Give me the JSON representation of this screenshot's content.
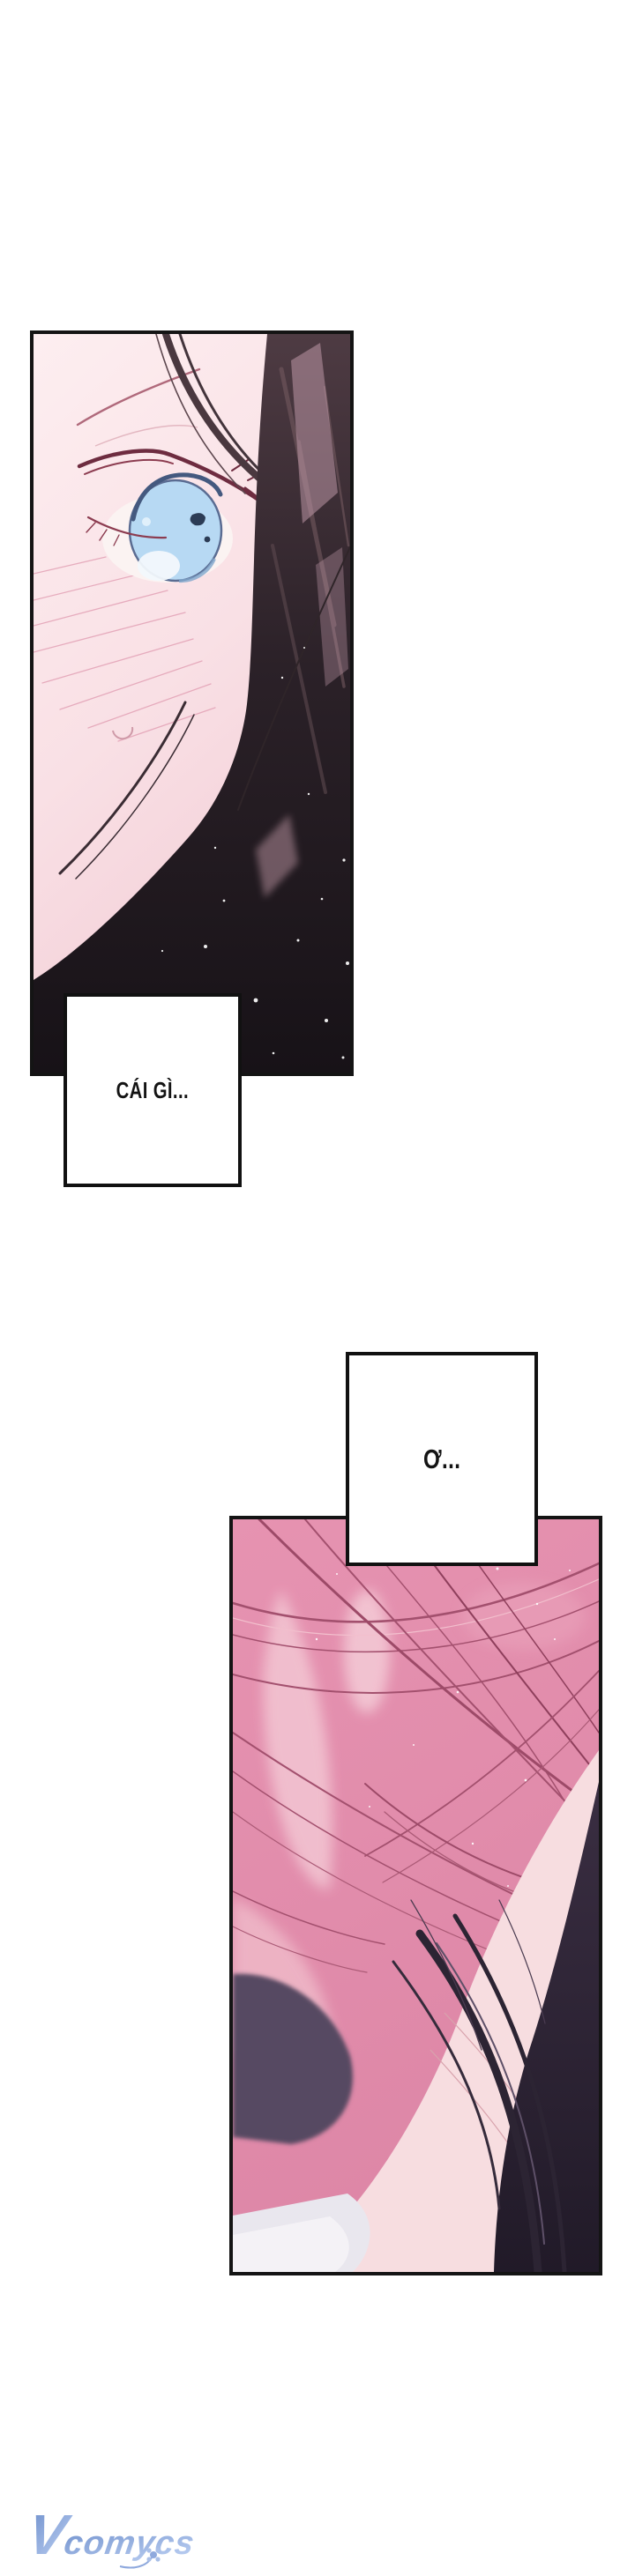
{
  "page": {
    "background": "#ffffff"
  },
  "speech": {
    "box1": "CÁI GÌ...",
    "box2": "Ơ..."
  },
  "watermark": {
    "initial": "V",
    "rest": "comycs"
  },
  "colors": {
    "panel_border": "#141414",
    "speech_text": "#141414",
    "skin_pale_pink": "#f8e3e6",
    "iris_blue": "#b7d9f3",
    "dark_hair": "#241d22",
    "pink_hair": "#e28fae",
    "pink_hair_line": "#a3506e",
    "shoulder_purple": "#564a62",
    "watermark_blue_light": "#b9cdf1",
    "watermark_blue_dark": "#6d8ecb"
  }
}
